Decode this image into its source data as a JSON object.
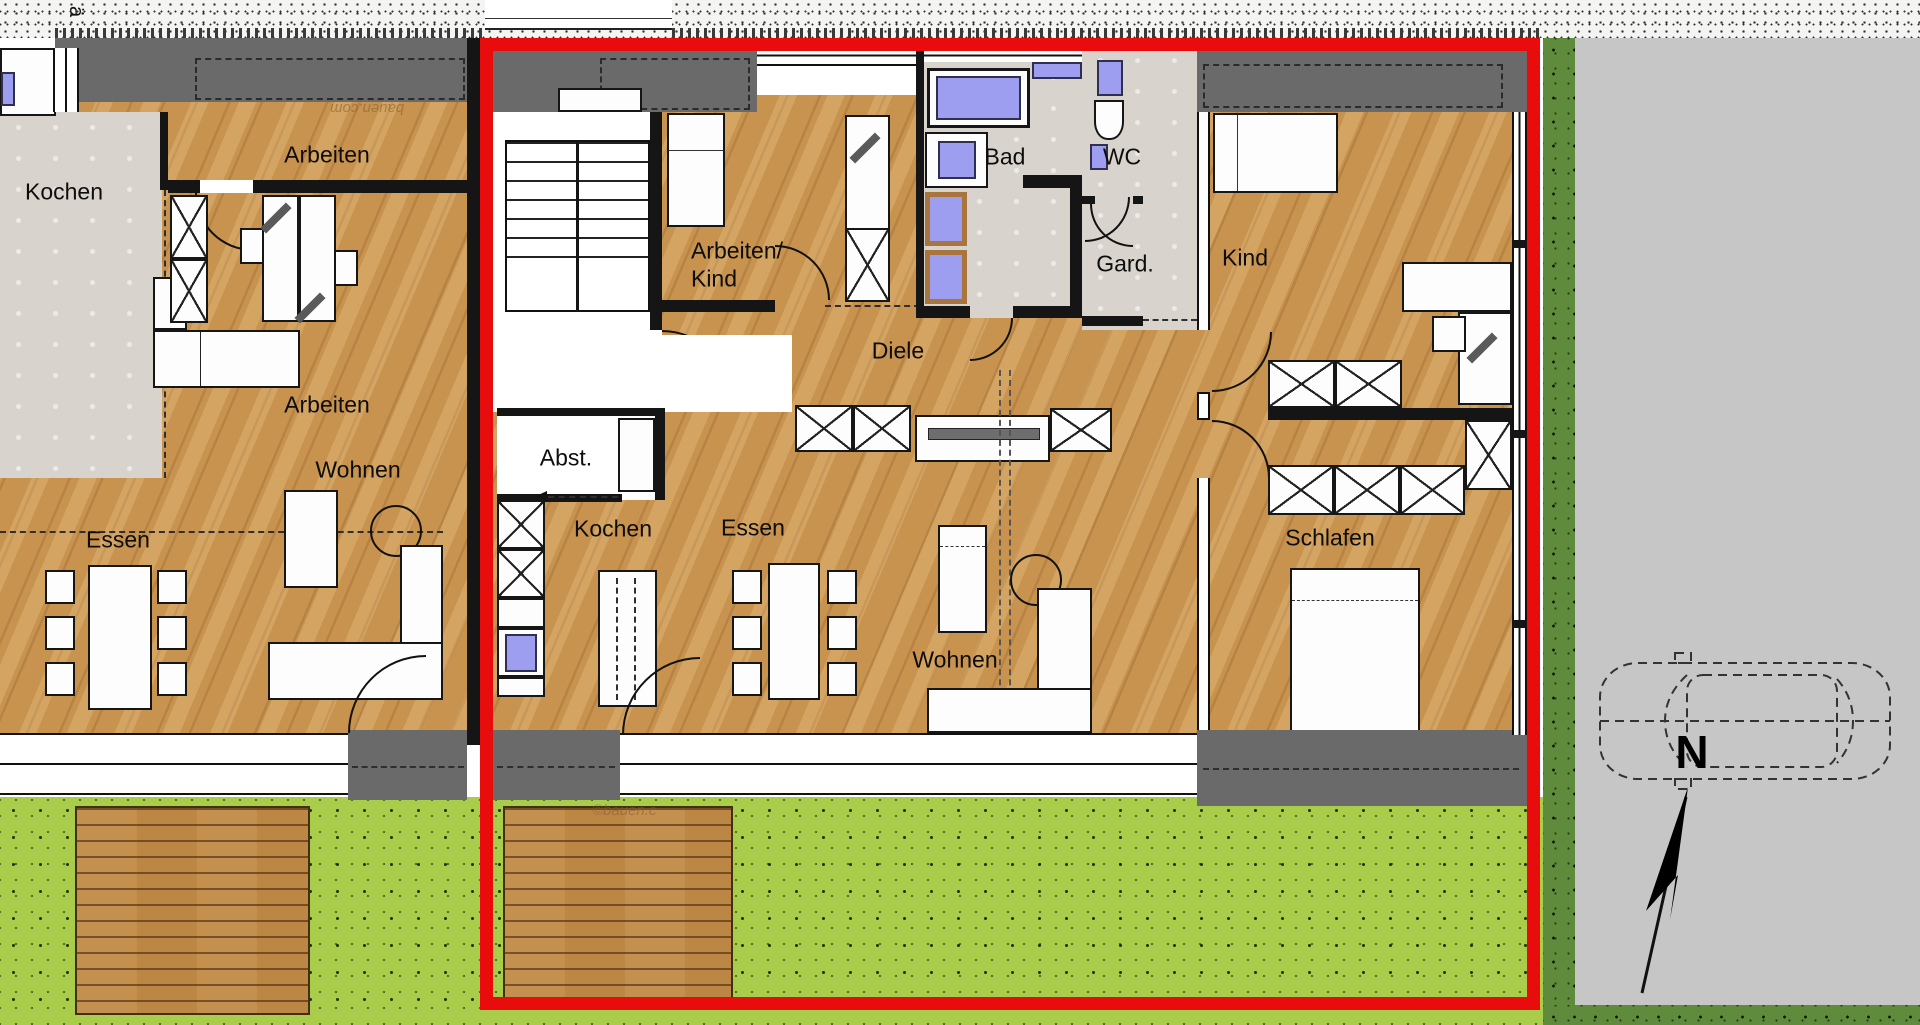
{
  "colors": {
    "red": "#e80c0c",
    "wood": "#c8924f",
    "deck": "#bc8645",
    "tile": "#d8d3cc",
    "lawn": "#a9cd4b",
    "lawndark": "#5f8c3c",
    "paving": "#c6c6c6",
    "wallgray": "#6a6a6a",
    "blue": "#9e9ef0"
  },
  "labels": {
    "kochen_left": "Kochen",
    "arbeiten_top": "Arbeiten",
    "arbeiten_mid": "Arbeiten",
    "wohnen_left": "Wohnen",
    "essen_left": "Essen",
    "arbeiten_kind_1": "Arbeiten/",
    "arbeiten_kind_2": "Kind",
    "bad": "Bad",
    "wc": "WC",
    "gard": "Gard.",
    "kind": "Kind",
    "diele": "Diele",
    "abst": "Abst.",
    "kochen_unit": "Kochen",
    "essen_unit": "Essen",
    "wohnen_unit": "Wohnen",
    "schlafen": "Schlafen",
    "north": "N",
    "watermark_top": "bauen.com",
    "watermark_bottom": "©bauen.c",
    "edge_glyph": "ä"
  }
}
